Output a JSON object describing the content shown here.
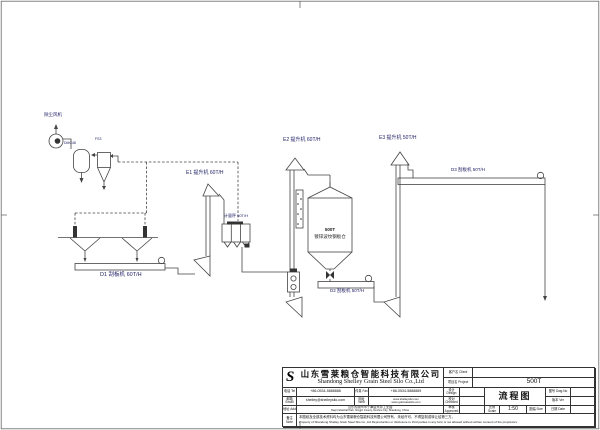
{
  "diagram": {
    "labels": {
      "fan": "除尘风机",
      "filter_model": "DMC48",
      "cyclone_model": "FS3",
      "elevator_e1": "E1 提升机 60T/H",
      "elevator_e2": "E2 提升机 60T/H",
      "elevator_e3": "E3 提升机 50T/H",
      "conveyor_d1": "D1 刮板机 60T/H",
      "conveyor_d2": "D2 刮板机 50T/H",
      "conveyor_d3": "D3 刮板机 50T/H",
      "weigher": "计量秤 60T/H",
      "silo_line1": "500T",
      "silo_line2": "镀锌波纹钢板仓"
    },
    "line_color": "#444444",
    "label_color": "#222266"
  },
  "title_block": {
    "logo": "S",
    "company_cn": "山东雪莱粮仓智能科技有限公司",
    "company_en": "Shandong Shelley Grain Steel Silo Co.,Ltd",
    "client_label": "客户名 Client",
    "client_value": "",
    "project_label": "项目名 Project",
    "project_value": "500T",
    "tel_label": "电话 Tel",
    "tel_value": "+86-0534-5888888",
    "fax_label": "传真 Fax",
    "fax_value": "+86-0534-5888889",
    "email_label": "邮箱 Email",
    "email_value": "shelley@shelleysilo.com",
    "web_label": "网址 Web",
    "web_value1": "www.shelleysilo.com",
    "web_value2": "www.grainsteelsilo.com",
    "add_label": "地址 Add",
    "add_value_cn": "山东省德州市宁津县大祁工业园",
    "add_value_en": "Daqi Industrial Park, Ningjin County, Dezhou City, Shandong, China",
    "design_label": "设计 Design",
    "checked_label": "校对 Checked",
    "approved_label": "审核 Approved",
    "drawing_name": "流程图",
    "scale_label": "比例 Scale",
    "scale_value": "1:50",
    "size_label": "图幅 Size",
    "dwg_no_label": "图号 Dwg.No",
    "version_label": "版本 Ver",
    "date_label": "日期 Date",
    "note_label": "备注 Note",
    "disclaimer_cn": "本图纸及全部技术资料均为山东雪莱粮仓智能科技有限公司所有，未经许可，不得复制或转让给第三方。",
    "disclaimer_en": "Property of Shandong Shelley Grain Steel Silo Co.,Ltd Reproduction or disclosure to third parties in any form is not allowed without written consent of the proprietors."
  }
}
